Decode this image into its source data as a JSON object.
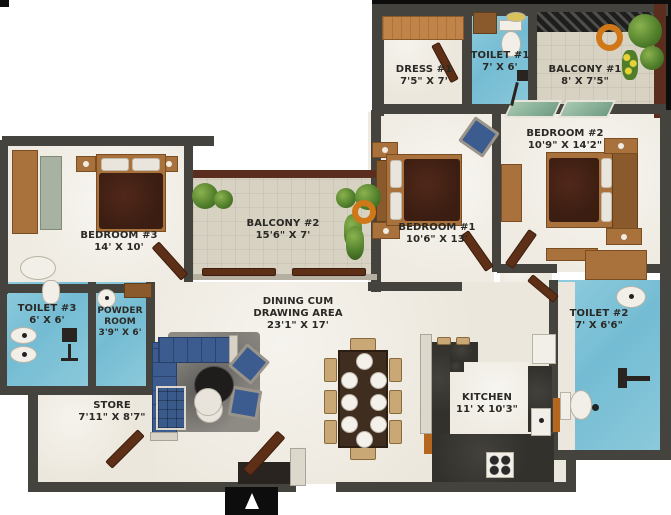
{
  "rooms": {
    "dress1": {
      "name": "DRESS #1",
      "size": "7'5\" X 7'"
    },
    "toilet1": {
      "name": "TOILET #1",
      "size": "7' X 6'"
    },
    "balcony1": {
      "name": "BALCONY #1",
      "size": "8' X 7'5\""
    },
    "bedroom2": {
      "name": "BEDROOM #2",
      "size": "10'9\" X 14'2\""
    },
    "bedroom1": {
      "name": "BEDROOM #1",
      "size": "10'6\" X 13'"
    },
    "bedroom3": {
      "name": "BEDROOM #3",
      "size": "14' X 10'"
    },
    "balcony2": {
      "name": "BALCONY #2",
      "size": "15'6\" X 7'"
    },
    "toilet3": {
      "name": "TOILET #3",
      "size": "6' X 6'"
    },
    "powder_room": {
      "name": "POWDER ROOM",
      "size": "3'9\" X 6'"
    },
    "toilet2": {
      "name": "TOILET #2",
      "size": "7' X 6'6\""
    },
    "dining": {
      "name": "DINING CUM DRAWING AREA",
      "size": "23'1\" X 17'"
    },
    "store": {
      "name": "STORE",
      "size": "7'11\" X 8'7\""
    },
    "kitchen": {
      "name": "KITCHEN",
      "size": "11' X 10'3\""
    }
  },
  "colors": {
    "wall": "#45433e",
    "toilet_tile": "#7cc4da",
    "floor_marble": "#ece7dc",
    "balcony_tile": "#d8d2c3",
    "wood": "#a9713c",
    "sofa_blue": "#3c5c90",
    "bed_maroon": "#3b1d12",
    "outer_border_maroon": "#5a2d1f",
    "plant_green": "#5c8f38"
  }
}
